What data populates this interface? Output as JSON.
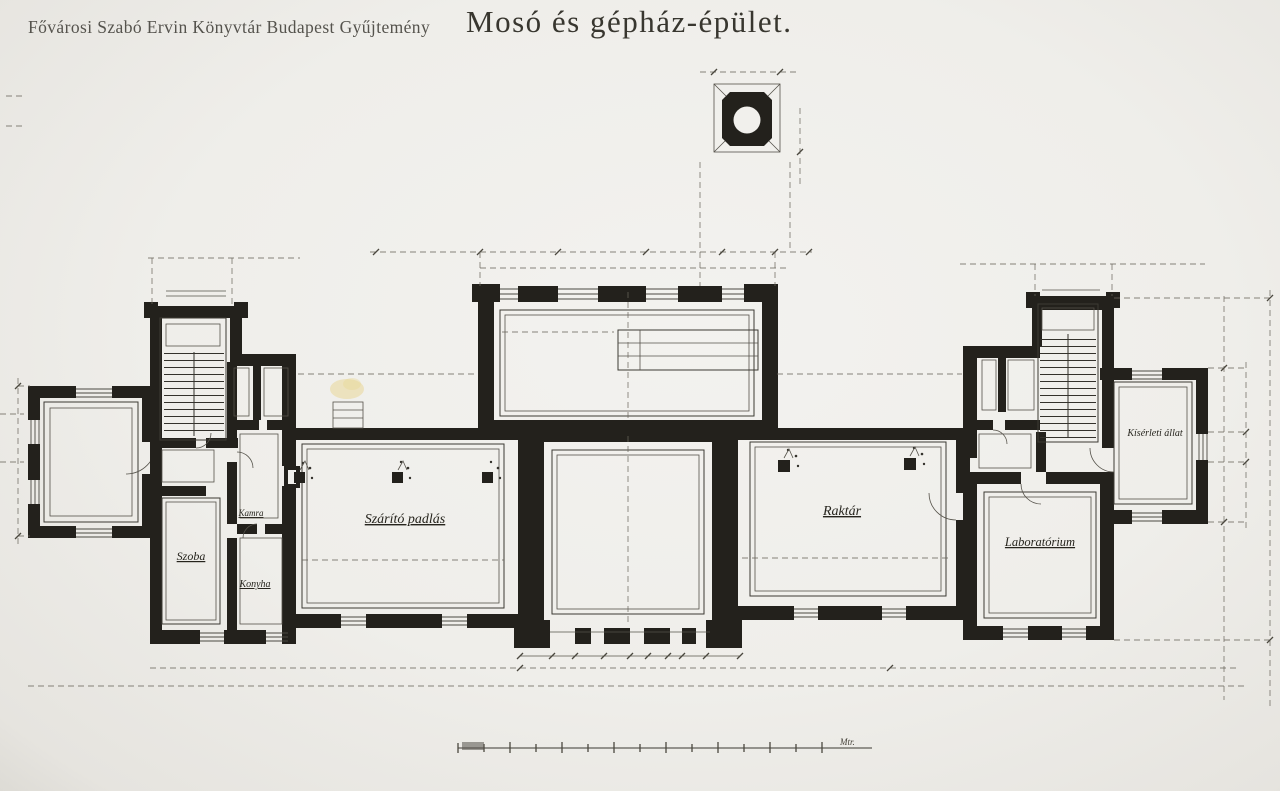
{
  "photo": {
    "watermark": "Fővárosi Szabó Ervin Könyvtár Budapest Gyűjtemény",
    "title": "Mosó és gépház-épület."
  },
  "plan": {
    "rooms": {
      "szoba": "Szoba",
      "kamra": "Kamra",
      "konyha": "Konyha",
      "szarito": "Szárító padlás",
      "raktar": "Raktár",
      "laboratorium": "Laboratórium",
      "kiserleti_allat": "Kísérleti állat"
    },
    "scale_unit": "Mtr."
  },
  "colors": {
    "ink": "#23211c",
    "paper": "#efeeea",
    "stain": "#e6cf7e"
  }
}
